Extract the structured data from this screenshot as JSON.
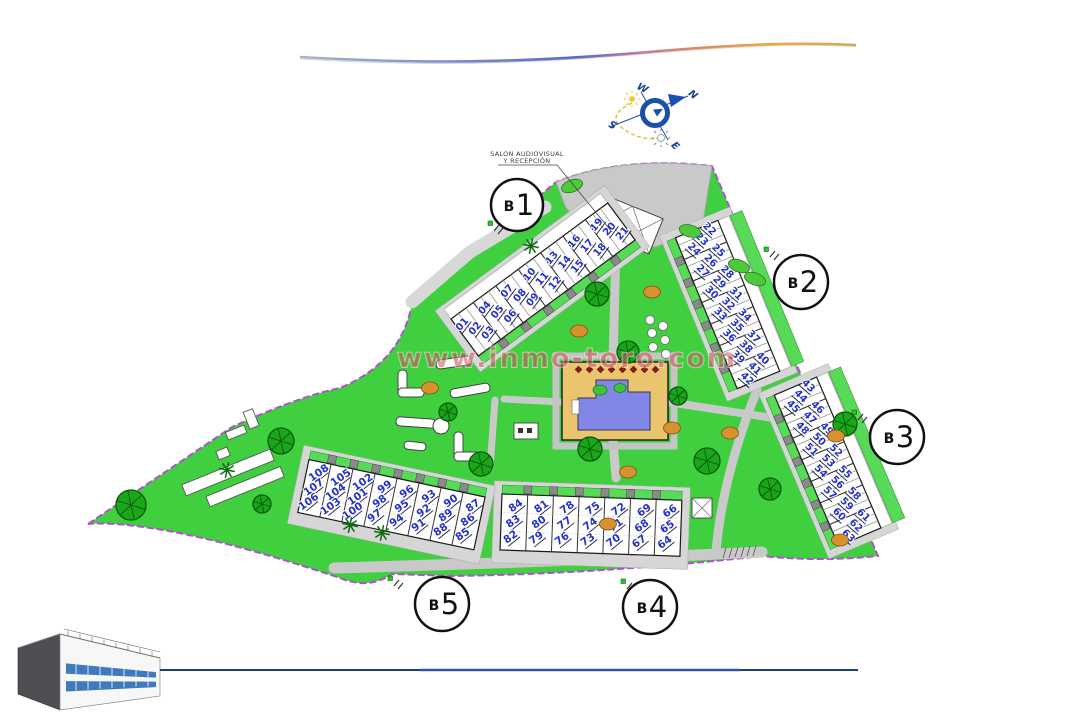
{
  "watermark": "www.inmo-toro.com",
  "compass": {
    "north": "N",
    "south": "S",
    "east": "E",
    "west": "W"
  },
  "reception_label": {
    "line1": "SALON AUDIOVISUAL",
    "line2": "Y RECEPCIÓN"
  },
  "blocks": [
    {
      "id": "b1",
      "prefix": "B",
      "digit": "1",
      "units": [
        "01",
        "02",
        "03",
        "04",
        "05",
        "06",
        "07",
        "08",
        "09",
        "10",
        "11",
        "12",
        "13",
        "14",
        "15",
        "16",
        "17",
        "18",
        "19",
        "20",
        "21"
      ]
    },
    {
      "id": "b2",
      "prefix": "B",
      "digit": "2",
      "units": [
        "22",
        "23",
        "24",
        "25",
        "26",
        "27",
        "28",
        "29",
        "30",
        "31",
        "32",
        "33",
        "34",
        "35",
        "36",
        "37",
        "38",
        "39",
        "40",
        "41",
        "42"
      ]
    },
    {
      "id": "b3",
      "prefix": "B",
      "digit": "3",
      "units": [
        "43",
        "44",
        "45",
        "46",
        "47",
        "48",
        "49",
        "50",
        "51",
        "52",
        "53",
        "54",
        "55",
        "56",
        "57",
        "58",
        "59",
        "60",
        "61",
        "62",
        "63"
      ]
    },
    {
      "id": "b4",
      "prefix": "B",
      "digit": "4",
      "units": [
        "64",
        "65",
        "66",
        "67",
        "68",
        "69",
        "70",
        "71",
        "72",
        "73",
        "74",
        "75",
        "76",
        "77",
        "78",
        "79",
        "80",
        "81",
        "82",
        "83",
        "84"
      ]
    },
    {
      "id": "b5",
      "prefix": "B",
      "digit": "5",
      "units": [
        "85",
        "86",
        "87",
        "88",
        "89",
        "90",
        "91",
        "92",
        "93",
        "94",
        "95",
        "96",
        "97",
        "98",
        "99",
        "100",
        "101",
        "102",
        "103",
        "104",
        "105",
        "106",
        "107",
        "108"
      ]
    }
  ],
  "colors": {
    "lawn_green": "#3fcf3f",
    "garden_green": "#57da57",
    "tree_green": "#1aa51a",
    "boundary_purple": "#b44fd0",
    "path_gray": "#c9c9c9",
    "building_white": "#ffffff",
    "unit_number_blue": "#2431c9",
    "pool_blue": "#8287e6",
    "pool_deck_tan": "#eac56e",
    "watermark_red": "#c8505a",
    "compass_blue": "#1a4fae",
    "sun_yellow": "#eec330",
    "logo_blue": "#2a6db5",
    "bottom_line_blue": "#1b3f7a",
    "shrub_orange": "#d6922f"
  }
}
